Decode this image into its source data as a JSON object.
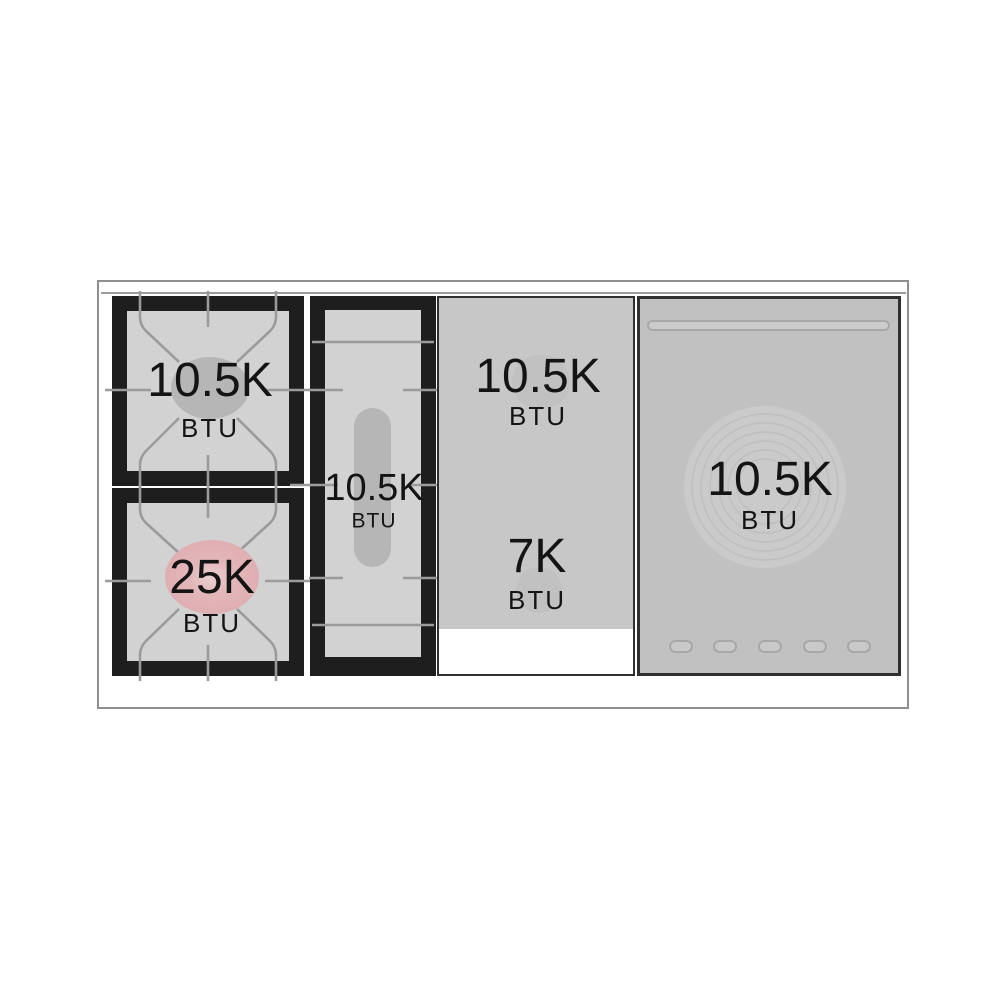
{
  "diagram": {
    "title": "range cooktop burner layout",
    "colors": {
      "frame_black": "#1e1e1e",
      "surface_gray": "#d2d2d2",
      "panel_gray": "#c7c7c7",
      "induction_gray": "#c1c1c1",
      "grate_line": "#9b9b9b",
      "accent_pink": "#dfaeb2",
      "text": "#141414",
      "outline": "#8f8f8f"
    }
  },
  "cooktop": {
    "burners": [
      {
        "id": "gas-burner-left-rear",
        "label": "10.5K",
        "unit": "BTU"
      },
      {
        "id": "gas-burner-left-front",
        "label": "25K",
        "unit": "BTU"
      },
      {
        "id": "oval-burner-center",
        "label": "10.5K",
        "unit": "BTU"
      },
      {
        "id": "zone-middle-rear",
        "label": "10.5K",
        "unit": "BTU"
      },
      {
        "id": "zone-middle-front",
        "label": "7K",
        "unit": "BTU"
      },
      {
        "id": "round-zone-right",
        "label": "10.5K",
        "unit": "BTU"
      }
    ]
  }
}
